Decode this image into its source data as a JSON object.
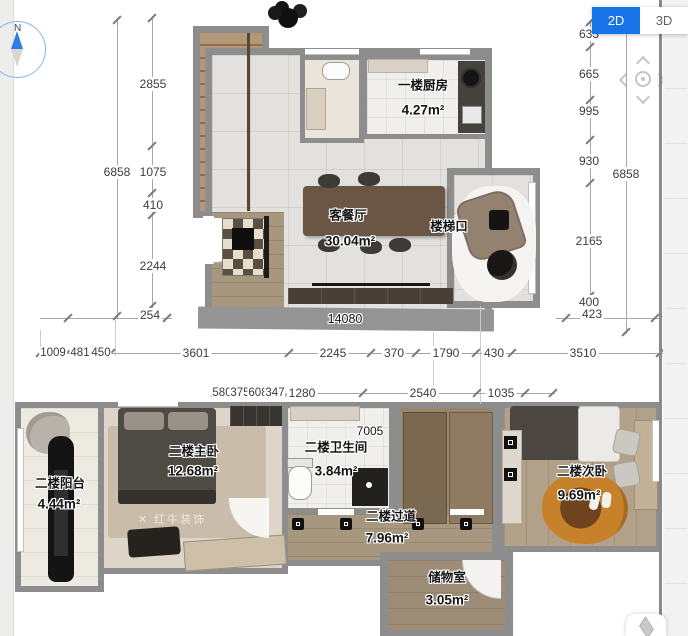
{
  "toolbar": {
    "view_2d": "2D",
    "view_3d": "3D"
  },
  "compass": {
    "north": "N"
  },
  "colors": {
    "accent_blue": "#1673e8",
    "wall_gray": "#8d8d8d"
  },
  "floor1": {
    "kitchen": {
      "name": "一楼厨房",
      "area": "4.27m²"
    },
    "living": {
      "name": "客餐厅",
      "area": "30.04m²"
    },
    "stair_label": "楼梯口"
  },
  "floor2": {
    "balcony": {
      "name": "二楼阳台",
      "area": "4.44m²"
    },
    "master": {
      "name": "二楼主卧",
      "area": "12.68m²"
    },
    "bath": {
      "name": "二楼卫生间",
      "area": "3.84m²"
    },
    "corridor": {
      "name": "二楼过道",
      "area": "7.96m²"
    },
    "bedroom2": {
      "name": "二楼次卧",
      "area": "9.69m²"
    },
    "storage": {
      "name": "储物室",
      "area": "3.05m²"
    }
  },
  "dims": {
    "left_total": "6858",
    "left_chain": [
      "2855",
      "1075",
      "410",
      "2244"
    ],
    "left_offset": "254",
    "right_total": "6858",
    "right_chain": [
      "633",
      "665",
      "995",
      "930",
      "2165",
      "400"
    ],
    "right_offset": "423",
    "bottom_total": "14080",
    "row1": [
      "1009",
      "481",
      "450",
      "3601",
      "2245",
      "370",
      "1790",
      "430",
      "3510"
    ],
    "row2": [
      "580",
      "375",
      "608",
      "347",
      "1280",
      "2540",
      "1035"
    ],
    "floor2_width": "7005"
  },
  "watermark": {
    "text": "红牛装饰"
  }
}
